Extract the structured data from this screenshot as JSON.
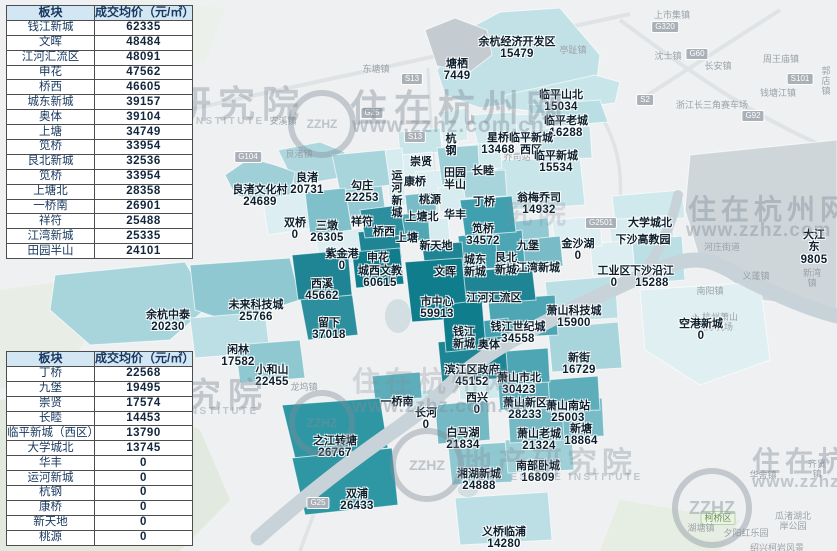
{
  "watermark": {
    "site": "住在杭州网",
    "url": "www.zzhz.com.cn",
    "url_short": "www.zzhz.com",
    "org": "地产研究院",
    "org_frag": "究院",
    "org_en": "REAL ESTATE INSTITUTE",
    "logo": "ZZHZ"
  },
  "tables": {
    "top": {
      "headers": [
        "板块",
        "成交均价（元/㎡）"
      ],
      "rows": [
        {
          "name": "钱江新城",
          "value": "62335"
        },
        {
          "name": "文晖",
          "value": "48484"
        },
        {
          "name": "江河汇流区",
          "value": "48091"
        },
        {
          "name": "申花",
          "value": "47562"
        },
        {
          "name": "桥西",
          "value": "46605"
        },
        {
          "name": "城东新城",
          "value": "39157"
        },
        {
          "name": "奥体",
          "value": "39104"
        },
        {
          "name": "上塘",
          "value": "34749"
        },
        {
          "name": "笕桥",
          "value": "33954"
        },
        {
          "name": "艮北新城",
          "value": "32536"
        },
        {
          "name": "笕桥",
          "value": "33954"
        },
        {
          "name": "上塘北",
          "value": "28358"
        },
        {
          "name": "一桥南",
          "value": "26901"
        },
        {
          "name": "祥符",
          "value": "25488"
        },
        {
          "name": "江湾新城",
          "value": "25335"
        },
        {
          "name": "田园半山",
          "value": "24101"
        }
      ]
    },
    "bottom": {
      "headers": [
        "板块",
        "成交均价（元/㎡）"
      ],
      "rows": [
        {
          "name": "丁桥",
          "value": "22568"
        },
        {
          "name": "九堡",
          "value": "19495"
        },
        {
          "name": "崇贤",
          "value": "17574"
        },
        {
          "name": "长睦",
          "value": "14453"
        },
        {
          "name": "临平新城（西区）",
          "value": "13790"
        },
        {
          "name": "大学城北",
          "value": "13745"
        },
        {
          "name": "华丰",
          "value": "0"
        },
        {
          "name": "运河新城",
          "value": "0"
        },
        {
          "name": "杭钢",
          "value": "0"
        },
        {
          "name": "康桥",
          "value": "0"
        },
        {
          "name": "新天地",
          "value": "0"
        },
        {
          "name": "桃源",
          "value": "0"
        }
      ]
    }
  },
  "map": {
    "palette": {
      "tier_darkest": "#107d8d",
      "tier_dark": "#1f8595",
      "tier_mid": "#4ea5b3",
      "tier_light": "#a8d4db",
      "tier_lightest": "#dceef1",
      "no_data_gray": "#c5ccd1",
      "river": "#c8d3d9"
    },
    "labels": [
      {
        "name": "塘栖",
        "value": "7449",
        "x": 457,
        "y": 45
      },
      {
        "name": "余杭经济开发区",
        "value": "15479",
        "x": 517,
        "y": 23
      },
      {
        "name": "临平山北",
        "value": "15034",
        "x": 561,
        "y": 76
      },
      {
        "name": "临平老城",
        "value": "16288",
        "x": 566,
        "y": 102
      },
      {
        "name": "星桥",
        "value": "13468",
        "x": 498,
        "y": 119
      },
      {
        "name": "临平新城\n西区",
        "value": "",
        "x": 531,
        "y": 119
      },
      {
        "name": "临平新城",
        "value": "15534",
        "x": 556,
        "y": 137
      },
      {
        "name": "翁梅乔司",
        "value": "14932",
        "x": 539,
        "y": 179
      },
      {
        "name": "田园\n半山",
        "value": "",
        "x": 455,
        "y": 154
      },
      {
        "name": "长睦",
        "value": "",
        "x": 483,
        "y": 152
      },
      {
        "name": "丁桥",
        "value": "",
        "x": 484,
        "y": 183
      },
      {
        "name": "华丰",
        "value": "",
        "x": 455,
        "y": 196
      },
      {
        "name": "桃源",
        "value": "",
        "x": 430,
        "y": 181
      },
      {
        "name": "新天地",
        "value": "",
        "x": 436,
        "y": 227
      },
      {
        "name": "杭\n钢",
        "value": "",
        "x": 451,
        "y": 120
      },
      {
        "name": "崇贤",
        "value": "",
        "x": 421,
        "y": 143
      },
      {
        "name": "良渚文化村",
        "value": "24689",
        "x": 260,
        "y": 171
      },
      {
        "name": "良渚",
        "value": "20731",
        "x": 307,
        "y": 159
      },
      {
        "name": "勾庄",
        "value": "22253",
        "x": 362,
        "y": 167
      },
      {
        "name": "运\n河\n新\n城",
        "value": "",
        "x": 397,
        "y": 157
      },
      {
        "name": "康桥",
        "value": "",
        "x": 415,
        "y": 163
      },
      {
        "name": "上塘北",
        "value": "",
        "x": 422,
        "y": 198
      },
      {
        "name": "双桥",
        "value": "0",
        "x": 295,
        "y": 204
      },
      {
        "name": "三墩",
        "value": "26305",
        "x": 327,
        "y": 207
      },
      {
        "name": "祥符",
        "value": "",
        "x": 362,
        "y": 203
      },
      {
        "name": "桥西",
        "value": "",
        "x": 384,
        "y": 213
      },
      {
        "name": "上塘",
        "value": "",
        "x": 407,
        "y": 219
      },
      {
        "name": "紫金港",
        "value": "0",
        "x": 342,
        "y": 235
      },
      {
        "name": "申花",
        "value": "",
        "x": 378,
        "y": 239
      },
      {
        "name": "城西文教",
        "value": "60615",
        "x": 380,
        "y": 252
      },
      {
        "name": "西溪",
        "value": "45662",
        "x": 322,
        "y": 265
      },
      {
        "name": "未来科技城",
        "value": "25766",
        "x": 256,
        "y": 286
      },
      {
        "name": "余杭中泰",
        "value": "20230",
        "x": 168,
        "y": 296
      },
      {
        "name": "留下",
        "value": "37018",
        "x": 329,
        "y": 304
      },
      {
        "name": "闲林",
        "value": "17582",
        "x": 238,
        "y": 331
      },
      {
        "name": "小和山",
        "value": "22455",
        "x": 272,
        "y": 351
      },
      {
        "name": "市中心",
        "value": "59913",
        "x": 437,
        "y": 283
      },
      {
        "name": "文晖",
        "value": "",
        "x": 445,
        "y": 253
      },
      {
        "name": "城东\n新城",
        "value": "",
        "x": 475,
        "y": 241
      },
      {
        "name": "艮北\n新城",
        "value": "",
        "x": 506,
        "y": 239
      },
      {
        "name": "江湾新城",
        "value": "",
        "x": 538,
        "y": 249
      },
      {
        "name": "九堡",
        "value": "",
        "x": 528,
        "y": 227
      },
      {
        "name": "笕桥",
        "value": "34572",
        "x": 483,
        "y": 210
      },
      {
        "name": "金沙湖",
        "value": "0",
        "x": 578,
        "y": 225
      },
      {
        "name": "江河汇流区",
        "value": "",
        "x": 494,
        "y": 279
      },
      {
        "name": "钱江\n新城",
        "value": "",
        "x": 464,
        "y": 313
      },
      {
        "name": "奥体",
        "value": "",
        "x": 489,
        "y": 326
      },
      {
        "name": "钱江世纪城",
        "value": "34558",
        "x": 518,
        "y": 308
      },
      {
        "name": "萧山科技城",
        "value": "15900",
        "x": 574,
        "y": 292
      },
      {
        "name": "大学城北",
        "value": "",
        "x": 650,
        "y": 204
      },
      {
        "name": "下沙高教园",
        "value": "",
        "x": 643,
        "y": 221
      },
      {
        "name": "工业区",
        "value": "0",
        "x": 614,
        "y": 252
      },
      {
        "name": "下沙沿江",
        "value": "15288",
        "x": 652,
        "y": 252
      },
      {
        "name": "大江东",
        "value": "9805",
        "x": 814,
        "y": 216
      },
      {
        "name": "空港新城",
        "value": "0",
        "x": 701,
        "y": 305
      },
      {
        "name": "滨江区政府",
        "value": "45152",
        "x": 472,
        "y": 351
      },
      {
        "name": "西兴",
        "value": "0",
        "x": 477,
        "y": 379
      },
      {
        "name": "萧山市北",
        "value": "30423",
        "x": 519,
        "y": 359
      },
      {
        "name": "新街",
        "value": "16729",
        "x": 579,
        "y": 339
      },
      {
        "name": "萧山新区",
        "value": "28233",
        "x": 525,
        "y": 384
      },
      {
        "name": "萧山南站",
        "value": "25003",
        "x": 568,
        "y": 387
      },
      {
        "name": "白马湖",
        "value": "21834",
        "x": 463,
        "y": 414
      },
      {
        "name": "萧山老城",
        "value": "21324",
        "x": 539,
        "y": 415
      },
      {
        "name": "新塘",
        "value": "18864",
        "x": 581,
        "y": 410
      },
      {
        "name": "南部卧城",
        "value": "16809",
        "x": 538,
        "y": 447
      },
      {
        "name": "湘湖新城",
        "value": "24888",
        "x": 479,
        "y": 455
      },
      {
        "name": "义桥临浦",
        "value": "14280",
        "x": 504,
        "y": 513
      },
      {
        "name": "一桥南",
        "value": "",
        "x": 397,
        "y": 383
      },
      {
        "name": "长河",
        "value": "0",
        "x": 426,
        "y": 394
      },
      {
        "name": "之江转塘",
        "value": "26767",
        "x": 335,
        "y": 422
      },
      {
        "name": "双浦",
        "value": "26433",
        "x": 357,
        "y": 475
      }
    ],
    "background_labels": [
      {
        "text": "上柏镇",
        "x": 170,
        "y": 57
      },
      {
        "text": "东塘镇",
        "x": 376,
        "y": 64
      },
      {
        "text": "安溪镇",
        "x": 283,
        "y": 116
      },
      {
        "text": "良渚镇",
        "x": 299,
        "y": 149
      },
      {
        "text": "亭趾镇",
        "x": 573,
        "y": 45
      },
      {
        "text": "乔司站",
        "x": 517,
        "y": 152
      },
      {
        "text": "上市集镇",
        "x": 672,
        "y": 10
      },
      {
        "text": "沈士镇",
        "x": 668,
        "y": 51
      },
      {
        "text": "长安镇",
        "x": 718,
        "y": 61
      },
      {
        "text": "周王庙镇",
        "x": 781,
        "y": 54
      },
      {
        "text": "郭店镇",
        "x": 826,
        "y": 66
      },
      {
        "text": "钱塘江镇",
        "x": 778,
        "y": 88
      },
      {
        "text": "浙江长三角赛车场",
        "x": 712,
        "y": 100
      },
      {
        "text": "河庄街道",
        "x": 722,
        "y": 242
      },
      {
        "text": "义蓬镇",
        "x": 756,
        "y": 271
      },
      {
        "text": "新湾镇",
        "x": 812,
        "y": 268
      },
      {
        "text": "南阳镇",
        "x": 710,
        "y": 286
      },
      {
        "text": "✈ 杭州萧山\n国际机场",
        "x": 715,
        "y": 312
      },
      {
        "text": "龙坞镇",
        "x": 304,
        "y": 382
      },
      {
        "text": "华舍镇",
        "x": 763,
        "y": 470
      },
      {
        "text": "齐贤镇",
        "x": 817,
        "y": 459
      },
      {
        "text": "柯桥区",
        "x": 718,
        "y": 511,
        "cls": "green-box"
      },
      {
        "text": "湖塘镇",
        "x": 701,
        "y": 523
      },
      {
        "text": "夕阳红乐园",
        "x": 746,
        "y": 528
      },
      {
        "text": "瓜渚湖北岸公园",
        "x": 793,
        "y": 511
      },
      {
        "text": "绍兴柯岩风景区",
        "x": 777,
        "y": 543
      }
    ],
    "road_shields": [
      {
        "text": "G104",
        "x": 248,
        "y": 151
      },
      {
        "text": "S13",
        "x": 412,
        "y": 73
      },
      {
        "text": "G25",
        "x": 372,
        "y": 107
      },
      {
        "text": "S13",
        "x": 415,
        "y": 131
      },
      {
        "text": "G320",
        "x": 665,
        "y": 21
      },
      {
        "text": "G60",
        "x": 697,
        "y": 48
      },
      {
        "text": "S2",
        "x": 645,
        "y": 94
      },
      {
        "text": "S101",
        "x": 800,
        "y": 73
      },
      {
        "text": "G92",
        "x": 753,
        "y": 110
      },
      {
        "text": "G2501",
        "x": 601,
        "y": 217
      },
      {
        "text": "G25",
        "x": 318,
        "y": 497
      }
    ]
  }
}
